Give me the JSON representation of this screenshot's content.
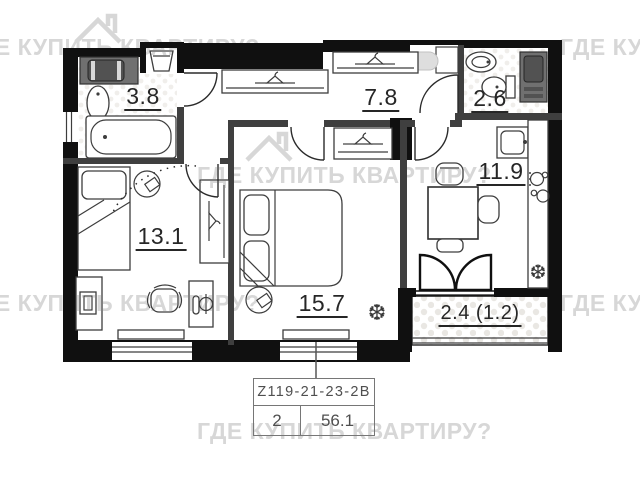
{
  "watermark": {
    "text": "ГДЕ КУПИТЬ КВАРТИРУ?"
  },
  "floor_plan": {
    "rooms": [
      {
        "name": "bathroom",
        "area": "3.8"
      },
      {
        "name": "hallway",
        "area": "7.8"
      },
      {
        "name": "toilet",
        "area": "2.6"
      },
      {
        "name": "bedroom-left",
        "area": "13.1"
      },
      {
        "name": "kitchen",
        "area": "11.9"
      },
      {
        "name": "bedroom-main",
        "area": "15.7"
      },
      {
        "name": "balcony",
        "area": "2.4 (1.2)"
      }
    ]
  },
  "icons": {
    "snowflake": "❆"
  },
  "info_box": {
    "plan_code": "Z119-21-23-2B",
    "rooms_count": "2",
    "total_area": "56.1"
  },
  "colors": {
    "wall": "#101010",
    "interior_wall": "#3f3f3f",
    "watermark": "#d7d7d7"
  }
}
